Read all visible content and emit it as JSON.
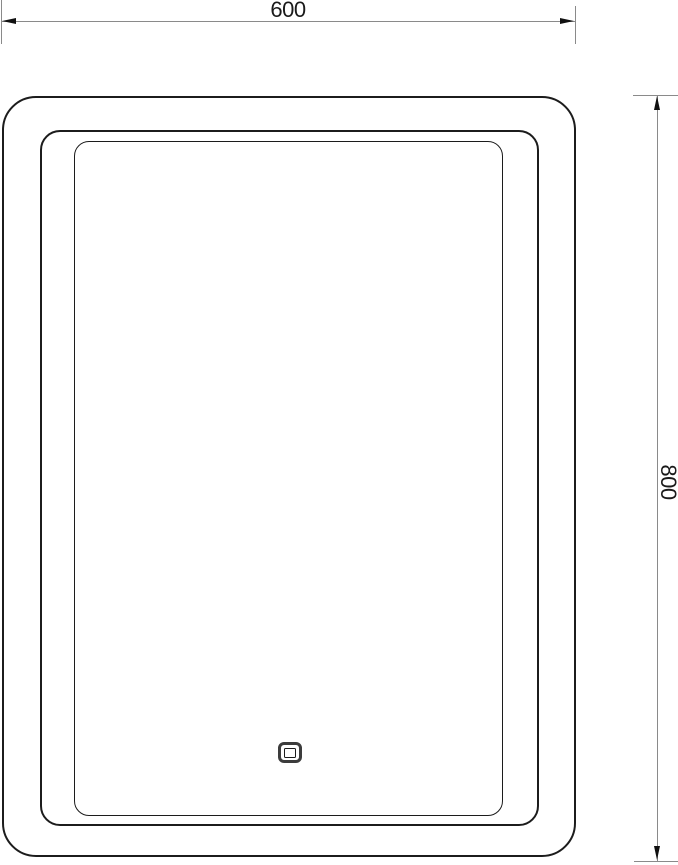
{
  "drawing": {
    "dimensions": {
      "width": "600",
      "height": "800"
    },
    "colors": {
      "background": "#ffffff",
      "outline": "#1c1c1c",
      "dimension_line": "#8a8a8a",
      "arrow": "#111111",
      "sensor_border": "#3c3c3c"
    },
    "icons": {
      "touch_sensor": "touch-sensor-icon"
    }
  }
}
